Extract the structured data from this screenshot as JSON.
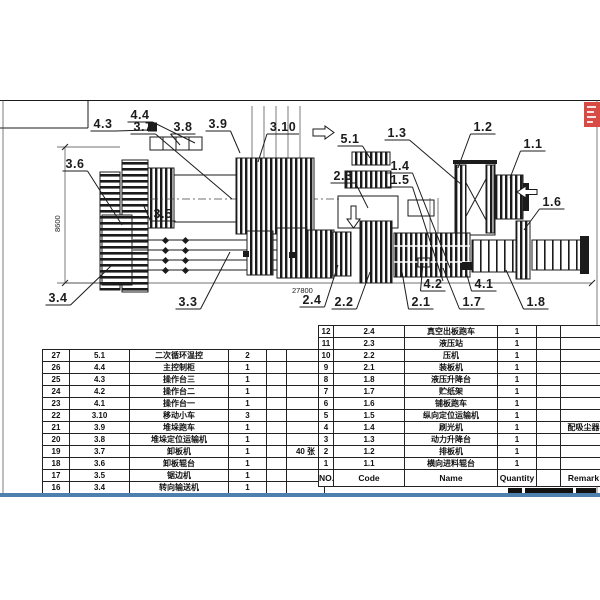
{
  "sheet": {
    "dim_height": "8600",
    "dim_length": "27800"
  },
  "colors": {
    "line": "#1b1b1b",
    "bottom_rule_blue": "#4f7fae",
    "stamp_red": "#d84b44"
  },
  "callouts": [
    {
      "label": "4.3",
      "x": 103,
      "y": 128,
      "tx": 148,
      "ty": 130
    },
    {
      "label": "4.4",
      "x": 140,
      "y": 119,
      "tx": 195,
      "ty": 143
    },
    {
      "label": "3.7",
      "x": 143,
      "y": 131,
      "tx": 232,
      "ty": 199
    },
    {
      "label": "3.8",
      "x": 183,
      "y": 131,
      "tx": 180,
      "ty": 145
    },
    {
      "label": "3.9",
      "x": 218,
      "y": 128,
      "tx": 240,
      "ty": 153
    },
    {
      "label": "3.10",
      "x": 283,
      "y": 131,
      "tx": 258,
      "ty": 162
    },
    {
      "label": "3.6",
      "x": 75,
      "y": 168,
      "tx": 122,
      "ty": 225
    },
    {
      "label": "3.5",
      "x": 163,
      "y": 218,
      "tx": 143,
      "ty": 204
    },
    {
      "label": "5.1",
      "x": 350,
      "y": 143,
      "tx": 370,
      "ty": 158
    },
    {
      "label": "1.3",
      "x": 397,
      "y": 137,
      "tx": 462,
      "ty": 185
    },
    {
      "label": "1.2",
      "x": 483,
      "y": 131,
      "tx": 458,
      "ty": 168
    },
    {
      "label": "1.1",
      "x": 533,
      "y": 148,
      "tx": 510,
      "ty": 178
    },
    {
      "label": "2.3",
      "x": 343,
      "y": 180,
      "tx": 368,
      "ty": 208
    },
    {
      "label": "1.4",
      "x": 400,
      "y": 170,
      "tx": 450,
      "ty": 268
    },
    {
      "label": "1.5",
      "x": 400,
      "y": 184,
      "tx": 443,
      "ty": 281
    },
    {
      "label": "1.6",
      "x": 552,
      "y": 206,
      "tx": 524,
      "ty": 230
    },
    {
      "label": "3.4",
      "x": 58,
      "y": 302,
      "tx": 112,
      "ty": 265
    },
    {
      "label": "3.3",
      "x": 188,
      "y": 306,
      "tx": 230,
      "ty": 252
    },
    {
      "label": "2.4",
      "x": 312,
      "y": 304,
      "tx": 338,
      "ty": 265
    },
    {
      "label": "2.2",
      "x": 344,
      "y": 306,
      "tx": 370,
      "ty": 272
    },
    {
      "label": "2.1",
      "x": 421,
      "y": 306,
      "tx": 402,
      "ty": 272
    },
    {
      "label": "4.2",
      "x": 433,
      "y": 288,
      "tx": 423,
      "ty": 263
    },
    {
      "label": "1.7",
      "x": 472,
      "y": 306,
      "tx": 443,
      "ty": 268
    },
    {
      "label": "4.1",
      "x": 484,
      "y": 288,
      "tx": 465,
      "ty": 268
    },
    {
      "label": "1.8",
      "x": 536,
      "y": 306,
      "tx": 506,
      "ty": 270
    }
  ],
  "left_table": {
    "rows": [
      [
        "27",
        "5.1",
        "二次循环温控",
        "2",
        "",
        ""
      ],
      [
        "26",
        "4.4",
        "主控制柜",
        "1",
        "",
        ""
      ],
      [
        "25",
        "4.3",
        "操作台三",
        "1",
        "",
        ""
      ],
      [
        "24",
        "4.2",
        "操作台二",
        "1",
        "",
        ""
      ],
      [
        "23",
        "4.1",
        "操作台一",
        "1",
        "",
        ""
      ],
      [
        "22",
        "3.10",
        "移动小车",
        "3",
        "",
        ""
      ],
      [
        "21",
        "3.9",
        "堆垛跑车",
        "1",
        "",
        ""
      ],
      [
        "20",
        "3.8",
        "堆垛定位运输机",
        "1",
        "",
        ""
      ],
      [
        "19",
        "3.7",
        "卸板机",
        "1",
        "",
        "40 张"
      ],
      [
        "18",
        "3.6",
        "卸板辊台",
        "1",
        "",
        ""
      ],
      [
        "17",
        "3.5",
        "锯边机",
        "1",
        "",
        ""
      ],
      [
        "16",
        "3.4",
        "转向输送机",
        "1",
        "",
        ""
      ]
    ]
  },
  "right_table": {
    "rows": [
      [
        "12",
        "2.4",
        "真空出板跑车",
        "1",
        "",
        ""
      ],
      [
        "11",
        "2.3",
        "液压站",
        "1",
        "",
        ""
      ],
      [
        "10",
        "2.2",
        "压机",
        "1",
        "",
        ""
      ],
      [
        "9",
        "2.1",
        "装板机",
        "1",
        "",
        ""
      ],
      [
        "8",
        "1.8",
        "液压升降台",
        "1",
        "",
        ""
      ],
      [
        "7",
        "1.7",
        "贮纸架",
        "1",
        "",
        ""
      ],
      [
        "6",
        "1.6",
        "铺板跑车",
        "1",
        "",
        ""
      ],
      [
        "5",
        "1.5",
        "纵向定位运输机",
        "1",
        "",
        ""
      ],
      [
        "4",
        "1.4",
        "刷光机",
        "1",
        "",
        "配吸尘器"
      ],
      [
        "3",
        "1.3",
        "动力升降台",
        "1",
        "",
        ""
      ],
      [
        "2",
        "1.2",
        "排板机",
        "1",
        "",
        ""
      ],
      [
        "1",
        "1.1",
        "横向进料辊台",
        "1",
        "",
        ""
      ]
    ],
    "header": [
      "NO.",
      "Code",
      "Name",
      "Quantity",
      "",
      "Remark"
    ]
  }
}
